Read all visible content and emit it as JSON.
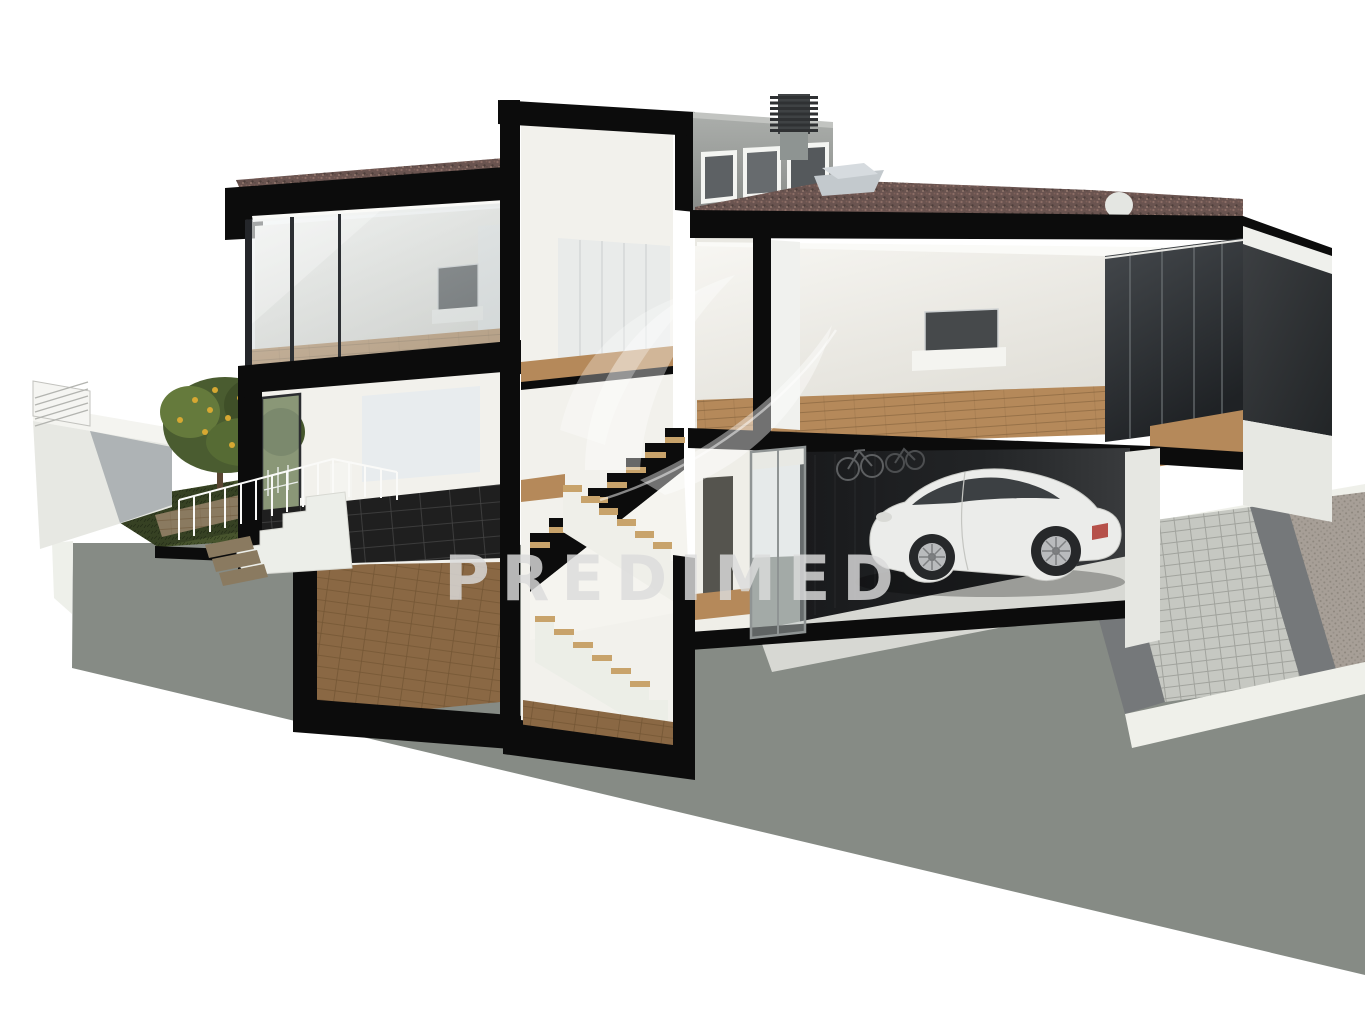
{
  "meta": {
    "title": "3D cutaway cross-section render of a modern two-storey villa with basement, central stair, garage and garden",
    "image_type": "architectural-section-3d-render"
  },
  "watermark": {
    "text": "PREDIMED",
    "color": "#dcdcdc",
    "logo": "leaf-swoosh"
  },
  "colors": {
    "background": "#ffffff",
    "ground": "#868b85",
    "cut_black": "#0c0c0c",
    "wall_white": "#f2f1ec",
    "ceiling_white": "#fafaf7",
    "wood_floor": "#b5895a",
    "wood_tread": "#c8a36b",
    "wood_dark": "#8a6844",
    "deck_wood": "#8a7a60",
    "roof_gravel": "#6a5450",
    "parapet_gray": "#9b9e9c",
    "glass_dark": "#2e3134",
    "grass_green": "#47542d",
    "foliage_green": "#4a5c30",
    "foliage_light": "#657a3c",
    "fruit_yellow": "#d7a832",
    "trunk_brown": "#5a4632",
    "car_body": "#ebecea",
    "car_glass": "#3c4043",
    "tail_light": "#b04038",
    "tile_dark": "#1f1f1f",
    "drive_light": "#c6c8c2",
    "drive_dark": "#a79f97",
    "drive_border": "#75787a",
    "skylight_gray": "#c3c9cd",
    "dome_white": "#e4e6e2",
    "chimney_dark": "#3f4244",
    "counter_white": "#f4f4f0",
    "railing_white": "#fafaf8",
    "stair_white": "#eceee9",
    "wardrobe_panel": "#e9ebea",
    "partition_glass": "#c7d0d0",
    "curb_white": "#eff0ea"
  }
}
